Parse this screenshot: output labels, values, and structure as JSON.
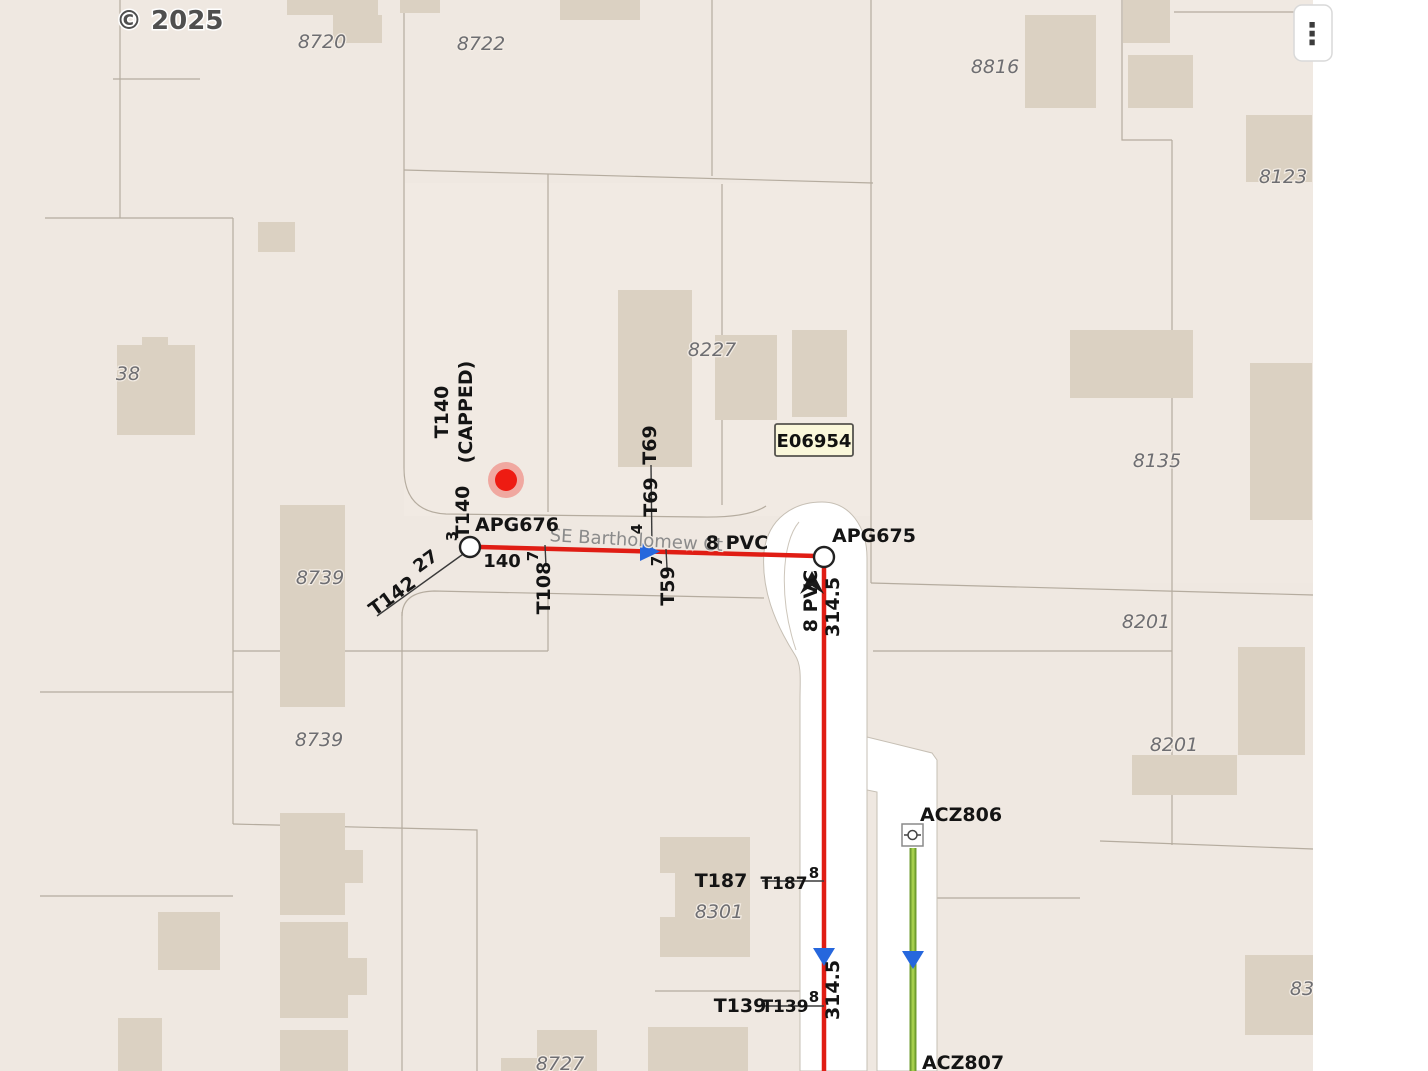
{
  "attribution": {
    "copyright": "© 2025"
  },
  "menu": {
    "glyph": "⋮"
  },
  "colors": {
    "pipe_red": "#E01D14",
    "pipe_green_outer": "#6F9E2F",
    "pipe_green_inner": "#A6CF4D",
    "arrow_blue": "#2667DD",
    "selection_red": "#EE1B12",
    "callout_bg": "#FAF7DA",
    "parcel_bg": "#EFE8E1",
    "building": "#DBD1C2",
    "road_white": "#FFFFFF"
  },
  "street": {
    "name": "SE Bartholomew Ct"
  },
  "callout": {
    "text": "E06954"
  },
  "parcels": [
    "8720",
    "8722",
    "8816",
    "8123",
    "38",
    "8227",
    "8135",
    "8739",
    "8739",
    "8201",
    "8201",
    "8301",
    "8727",
    "83"
  ],
  "nodes": {
    "apg676": "APG676",
    "apg675": "APG675",
    "acz806": "ACZ806",
    "acz807": "ACZ807"
  },
  "taps": {
    "t140_capped_1": "T140",
    "t140_capped_2": "(CAPPED)",
    "t140": "T140",
    "t142": "T142",
    "t108": "T108",
    "t69_a": "T69",
    "t69_b": "T69",
    "t59": "T59",
    "t187_a": "T187",
    "t187_b": "T187",
    "t139_a": "T139",
    "t139_b": "T139"
  },
  "dims": {
    "d3": "3",
    "d140": "140",
    "d27": "27",
    "d7a": "7",
    "d7b": "7",
    "d4": "4",
    "d8a": "8",
    "d8b": "8",
    "len_a": "314.5",
    "len_b": "314.5",
    "pvc_h": "8 PVC",
    "pvc_v": "8 PVC"
  }
}
